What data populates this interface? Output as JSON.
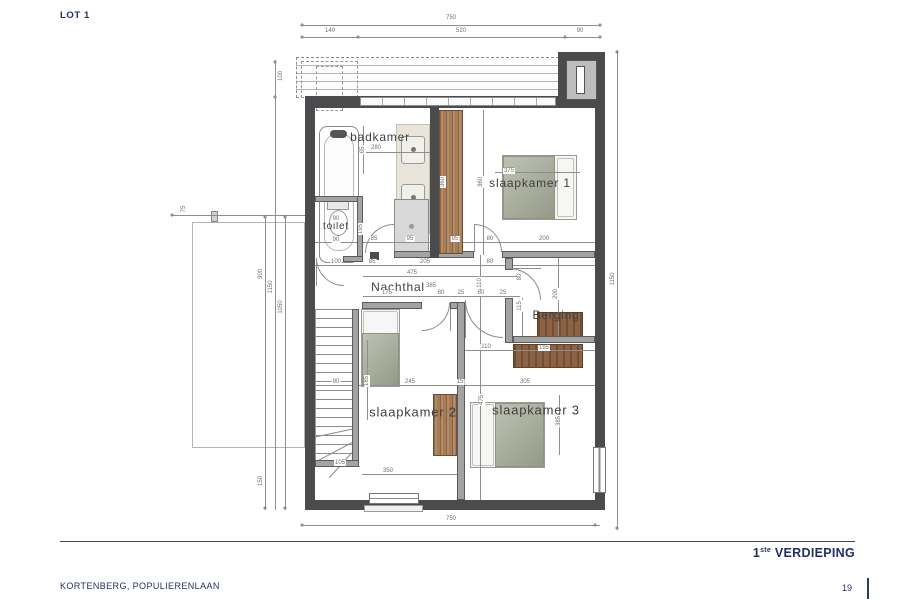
{
  "meta": {
    "lot": "LOT 1",
    "project": "KORTENBERG, POPULIERENLAAN",
    "page": "19",
    "title_num": "1",
    "title_sup": "ste",
    "title_rest": " VERDIEPING"
  },
  "plan": {
    "rooms": [
      {
        "t": "badkamer",
        "x": 380,
        "y": 137,
        "fs": 12
      },
      {
        "t": "toilet",
        "x": 336,
        "y": 227,
        "fs": 10
      },
      {
        "t": "slaapkamer 1",
        "x": 530,
        "y": 183,
        "fs": 12
      },
      {
        "t": "Nachthal",
        "x": 398,
        "y": 287,
        "fs": 12
      },
      {
        "t": "Berging",
        "x": 556,
        "y": 315,
        "fs": 12
      },
      {
        "t": "slaapkamer 2",
        "x": 413,
        "y": 412,
        "fs": 13
      },
      {
        "t": "slaapkamer 3",
        "x": 536,
        "y": 410,
        "fs": 13
      }
    ],
    "dims": [
      {
        "t": "750",
        "x": 451,
        "y": 18
      },
      {
        "t": "140",
        "x": 330,
        "y": 31
      },
      {
        "t": "520",
        "x": 461,
        "y": 31
      },
      {
        "t": "90",
        "x": 580,
        "y": 31
      },
      {
        "t": "75",
        "x": 184,
        "y": 209,
        "r": 1
      },
      {
        "t": "100",
        "x": 281,
        "y": 76,
        "r": 1
      },
      {
        "t": "900",
        "x": 261,
        "y": 274,
        "r": 1
      },
      {
        "t": "1150",
        "x": 271,
        "y": 287,
        "r": 1
      },
      {
        "t": "1050",
        "x": 281,
        "y": 307,
        "r": 1
      },
      {
        "t": "150",
        "x": 261,
        "y": 481,
        "r": 1
      },
      {
        "t": "1150",
        "x": 613,
        "y": 279,
        "r": 1
      },
      {
        "t": "750",
        "x": 451,
        "y": 519
      },
      {
        "t": "280",
        "x": 376,
        "y": 148
      },
      {
        "t": "65",
        "x": 363,
        "y": 150,
        "r": 1
      },
      {
        "t": "360",
        "x": 443,
        "y": 182,
        "r": 1
      },
      {
        "t": "360",
        "x": 481,
        "y": 182,
        "r": 1
      },
      {
        "t": "375",
        "x": 509,
        "y": 171
      },
      {
        "t": "90",
        "x": 336,
        "y": 219
      },
      {
        "t": "90",
        "x": 336,
        "y": 240
      },
      {
        "t": "195",
        "x": 361,
        "y": 229,
        "r": 1
      },
      {
        "t": "85",
        "x": 374,
        "y": 239
      },
      {
        "t": "95",
        "x": 410,
        "y": 239
      },
      {
        "t": "95",
        "x": 455,
        "y": 239
      },
      {
        "t": "80",
        "x": 490,
        "y": 239
      },
      {
        "t": "200",
        "x": 544,
        "y": 239
      },
      {
        "t": "100",
        "x": 336,
        "y": 262
      },
      {
        "t": "85",
        "x": 372,
        "y": 262
      },
      {
        "t": "205",
        "x": 425,
        "y": 262
      },
      {
        "t": "80",
        "x": 490,
        "y": 262
      },
      {
        "t": "475",
        "x": 412,
        "y": 273
      },
      {
        "t": "385",
        "x": 431,
        "y": 286
      },
      {
        "t": "175",
        "x": 387,
        "y": 293
      },
      {
        "t": "80",
        "x": 441,
        "y": 293
      },
      {
        "t": "25",
        "x": 461,
        "y": 293
      },
      {
        "t": "80",
        "x": 481,
        "y": 293
      },
      {
        "t": "25",
        "x": 503,
        "y": 293
      },
      {
        "t": "110",
        "x": 480,
        "y": 283,
        "r": 1
      },
      {
        "t": "80",
        "x": 520,
        "y": 277,
        "r": 1
      },
      {
        "t": "115",
        "x": 520,
        "y": 306,
        "r": 1
      },
      {
        "t": "200",
        "x": 556,
        "y": 294,
        "r": 1
      },
      {
        "t": "90",
        "x": 336,
        "y": 382
      },
      {
        "t": "185",
        "x": 367,
        "y": 381,
        "r": 1
      },
      {
        "t": "245",
        "x": 410,
        "y": 382
      },
      {
        "t": "15",
        "x": 460,
        "y": 382
      },
      {
        "t": "305",
        "x": 525,
        "y": 382
      },
      {
        "t": "110",
        "x": 486,
        "y": 347
      },
      {
        "t": "195",
        "x": 544,
        "y": 348
      },
      {
        "t": "475",
        "x": 482,
        "y": 400,
        "r": 1
      },
      {
        "t": "385",
        "x": 559,
        "y": 421,
        "r": 1
      },
      {
        "t": "105",
        "x": 340,
        "y": 463
      },
      {
        "t": "350",
        "x": 388,
        "y": 471
      }
    ],
    "dash_areas": [
      {
        "x": 296,
        "y": 57,
        "w": 303,
        "h": 41,
        "cls": "dash-strip",
        "name": "roof-overhang"
      },
      {
        "x": 301,
        "y": 61,
        "w": 57,
        "h": 37,
        "cls": "dash-box",
        "name": "skylight-outline"
      },
      {
        "x": 316,
        "y": 66,
        "w": 27,
        "h": 45,
        "cls": "dash-box",
        "name": "skylight-outline"
      }
    ],
    "dim_lines": [
      [
        302,
        25,
        298,
        1
      ],
      [
        302,
        37,
        298,
        1
      ],
      [
        617,
        50,
        1,
        480
      ],
      [
        302,
        525,
        298,
        1
      ],
      [
        265,
        215,
        1,
        295
      ],
      [
        275,
        60,
        1,
        450
      ],
      [
        285,
        215,
        1,
        295
      ],
      [
        172,
        215,
        133,
        1
      ],
      [
        315,
        242,
        280,
        1
      ],
      [
        315,
        265,
        280,
        1
      ],
      [
        363,
        276,
        157,
        1
      ],
      [
        363,
        296,
        157,
        1
      ],
      [
        315,
        385,
        280,
        1
      ],
      [
        465,
        350,
        130,
        1
      ],
      [
        315,
        466,
        45,
        1
      ],
      [
        362,
        474,
        96,
        1
      ],
      [
        363,
        152,
        67,
        1
      ],
      [
        495,
        172,
        85,
        1
      ],
      [
        480,
        255,
        1,
        245
      ],
      [
        442,
        110,
        1,
        145
      ],
      [
        483,
        110,
        1,
        145
      ],
      [
        558,
        258,
        1,
        78
      ],
      [
        559,
        395,
        1,
        60
      ],
      [
        367,
        340,
        1,
        80
      ],
      [
        522,
        298,
        1,
        38
      ],
      [
        363,
        126,
        1,
        48
      ],
      [
        394,
        225,
        1,
        28
      ],
      [
        474,
        224,
        1,
        28
      ],
      [
        316,
        258,
        1,
        28
      ],
      [
        450,
        303,
        1,
        28
      ],
      [
        465,
        300,
        1,
        38
      ],
      [
        509,
        268,
        32,
        1
      ]
    ],
    "ticks": [
      [
        302,
        25
      ],
      [
        600,
        25
      ],
      [
        302,
        37
      ],
      [
        358,
        37
      ],
      [
        565,
        37
      ],
      [
        600,
        37
      ],
      [
        302,
        525
      ],
      [
        595,
        525
      ],
      [
        617,
        52
      ],
      [
        617,
        528
      ],
      [
        265,
        217
      ],
      [
        265,
        508
      ],
      [
        275,
        62
      ],
      [
        275,
        97
      ],
      [
        285,
        217
      ],
      [
        285,
        508
      ],
      [
        172,
        215
      ]
    ],
    "boxes_under": [
      {
        "x": 192,
        "y": 222,
        "w": 113,
        "h": 226,
        "cls": "terrace",
        "name": "lower-roof-outline"
      },
      {
        "x": 211,
        "y": 211,
        "w": 7,
        "h": 11,
        "bg": "#cfcfcf",
        "bd": "1px solid #888",
        "name": "wall-marker"
      },
      {
        "x": 319,
        "y": 126,
        "w": 40,
        "h": 137,
        "bg": "#ffffff",
        "bd": "1px solid #8a8a8a",
        "rad": 8,
        "name": "bathtub"
      },
      {
        "x": 324,
        "y": 133,
        "w": 30,
        "h": 118,
        "bg": "#fdfdfd",
        "bd": "1px solid #b5b5b5",
        "rad": 14,
        "name": "bathtub-basin"
      },
      {
        "x": 330,
        "y": 130,
        "w": 17,
        "h": 8,
        "bg": "#555",
        "rad": 6,
        "name": "bathtub-faucet"
      },
      {
        "x": 396,
        "y": 124,
        "w": 34,
        "h": 110,
        "bg": "#eae5da",
        "bd": "1px solid #c5c0b2",
        "name": "vanity-counter"
      },
      {
        "x": 401,
        "y": 136,
        "w": 24,
        "h": 28,
        "bg": "#f2f0ea",
        "bd": "1px solid #999",
        "rad": 3,
        "name": "washbasin"
      },
      {
        "x": 401,
        "y": 184,
        "w": 24,
        "h": 28,
        "bg": "#f2f0ea",
        "bd": "1px solid #999",
        "rad": 3,
        "name": "washbasin"
      },
      {
        "x": 411,
        "y": 147,
        "w": 5,
        "h": 5,
        "bg": "#777",
        "rad": 5,
        "name": "faucet"
      },
      {
        "x": 411,
        "y": 195,
        "w": 5,
        "h": 5,
        "bg": "#777",
        "rad": 5,
        "name": "faucet"
      },
      {
        "x": 394,
        "y": 199,
        "w": 35,
        "h": 55,
        "bg": "#d8d8d8",
        "bd": "1px solid #8a8a8a",
        "name": "shower"
      },
      {
        "x": 409,
        "y": 224,
        "w": 5,
        "h": 5,
        "bg": "#9a9a9a",
        "rad": 5,
        "name": "shower-drain"
      },
      {
        "x": 327,
        "y": 201,
        "w": 22,
        "h": 9,
        "bg": "#e8e8e8",
        "bd": "1px solid #999",
        "name": "toilet-tank"
      },
      {
        "x": 329,
        "y": 210,
        "w": 19,
        "h": 26,
        "cls": "oval",
        "bg": "#ffffff",
        "bd": "1px solid #999",
        "name": "toilet-bowl"
      },
      {
        "x": 502,
        "y": 155,
        "w": 75,
        "h": 65,
        "bg": "#f5f5f3",
        "bd": "1px solid #9a9a9a",
        "name": "bed-slaapkamer1"
      },
      {
        "x": 503,
        "y": 156,
        "w": 52,
        "h": 63,
        "cls": "blanket",
        "name": "bed-blanket"
      },
      {
        "x": 557,
        "y": 158,
        "w": 17,
        "h": 59,
        "cls": "pillow",
        "name": "bed-pillow"
      },
      {
        "x": 361,
        "y": 309,
        "w": 39,
        "h": 78,
        "bg": "#f5f5f3",
        "bd": "1px solid #9a9a9a",
        "name": "bed-slaapkamer2"
      },
      {
        "x": 363,
        "y": 311,
        "w": 35,
        "h": 24,
        "cls": "pillow",
        "name": "bed-pillow"
      },
      {
        "x": 362,
        "y": 333,
        "w": 37,
        "h": 53,
        "cls": "blanket",
        "name": "bed-blanket"
      },
      {
        "x": 470,
        "y": 402,
        "w": 75,
        "h": 66,
        "bg": "#f5f5f3",
        "bd": "1px solid #9a9a9a",
        "name": "bed-slaapkamer3"
      },
      {
        "x": 472,
        "y": 404,
        "w": 22,
        "h": 62,
        "cls": "pillow",
        "name": "bed-pillow"
      },
      {
        "x": 495,
        "y": 403,
        "w": 49,
        "h": 64,
        "cls": "blanket",
        "name": "bed-blanket"
      },
      {
        "x": 433,
        "y": 394,
        "w": 24,
        "h": 62,
        "cls": "wood",
        "name": "desk-slaapkamer2"
      },
      {
        "x": 537,
        "y": 312,
        "w": 46,
        "h": 30,
        "cls": "woodD",
        "name": "cabinet-berging"
      },
      {
        "x": 513,
        "y": 344,
        "w": 70,
        "h": 24,
        "cls": "woodD",
        "name": "cabinet-berging"
      }
    ],
    "stairs": {
      "x": 315,
      "y": 309,
      "w": 40,
      "h": 152
    },
    "winders": [
      {
        "x": 313,
        "y": 428,
        "w": 42,
        "deg": -12
      },
      {
        "x": 314,
        "y": 441,
        "w": 40,
        "deg": -28
      },
      {
        "x": 318,
        "y": 452,
        "w": 34,
        "deg": -48
      }
    ],
    "walls_gray": [
      [
        394,
        251,
        44,
        7
      ],
      [
        438,
        251,
        36,
        7
      ],
      [
        502,
        251,
        93,
        7
      ],
      [
        315,
        196,
        48,
        6
      ],
      [
        357,
        196,
        6,
        66
      ],
      [
        343,
        256,
        20,
        6
      ],
      [
        352,
        309,
        7,
        158
      ],
      [
        315,
        460,
        44,
        7
      ],
      [
        362,
        302,
        60,
        7
      ],
      [
        450,
        302,
        14,
        7
      ],
      [
        457,
        302,
        8,
        198
      ],
      [
        505,
        298,
        8,
        45
      ],
      [
        513,
        336,
        82,
        7
      ],
      [
        505,
        258,
        8,
        12
      ]
    ],
    "walls_dark": [
      [
        305,
        96,
        300,
        12
      ],
      [
        305,
        96,
        10,
        414
      ],
      [
        595,
        96,
        10,
        414
      ],
      [
        305,
        500,
        300,
        10
      ],
      [
        430,
        106,
        9,
        152
      ],
      [
        558,
        52,
        47,
        56
      ],
      [
        370,
        252,
        9,
        8
      ]
    ],
    "wood_panels": [
      {
        "x": 439,
        "y": 110,
        "w": 24,
        "h": 144,
        "name": "wardrobe"
      }
    ],
    "boxes_over": [
      {
        "x": 360,
        "y": 97,
        "w": 196,
        "h": 9,
        "cls": "band",
        "name": "rooflight-band"
      },
      {
        "x": 566,
        "y": 60,
        "w": 31,
        "h": 40,
        "bg": "#bdbdbd",
        "bd": "1px solid #555",
        "name": "chimney-inner"
      },
      {
        "x": 576,
        "y": 66,
        "w": 9,
        "h": 28,
        "bg": "#ffffff",
        "bd": "1px solid #555",
        "name": "chimney-flue"
      },
      {
        "x": 364,
        "y": 505,
        "w": 59,
        "h": 7,
        "bg": "#f1f1f1",
        "bd": "1px solid #9a9a9a",
        "name": "window-sill"
      },
      {
        "x": 369,
        "y": 493,
        "w": 50,
        "h": 11,
        "cls": "winh",
        "name": "window-bottom"
      },
      {
        "x": 593,
        "y": 447,
        "w": 13,
        "h": 46,
        "cls": "winv",
        "name": "window-right"
      }
    ],
    "arcs": [
      {
        "x": 365,
        "y": 224,
        "r": 29,
        "c": "tl",
        "name": "door-badkamer"
      },
      {
        "x": 474,
        "y": 224,
        "r": 28,
        "c": "tr",
        "name": "door-slaapkamer1"
      },
      {
        "x": 316,
        "y": 258,
        "r": 28,
        "c": "bl",
        "name": "door-toilet"
      },
      {
        "x": 422,
        "y": 303,
        "r": 28,
        "c": "br",
        "name": "door-slaapkamer2"
      },
      {
        "x": 465,
        "y": 300,
        "r": 38,
        "c": "bl",
        "name": "door-slaapkamer3"
      },
      {
        "x": 509,
        "y": 268,
        "r": 32,
        "c": "tr",
        "name": "door-berging"
      }
    ]
  }
}
